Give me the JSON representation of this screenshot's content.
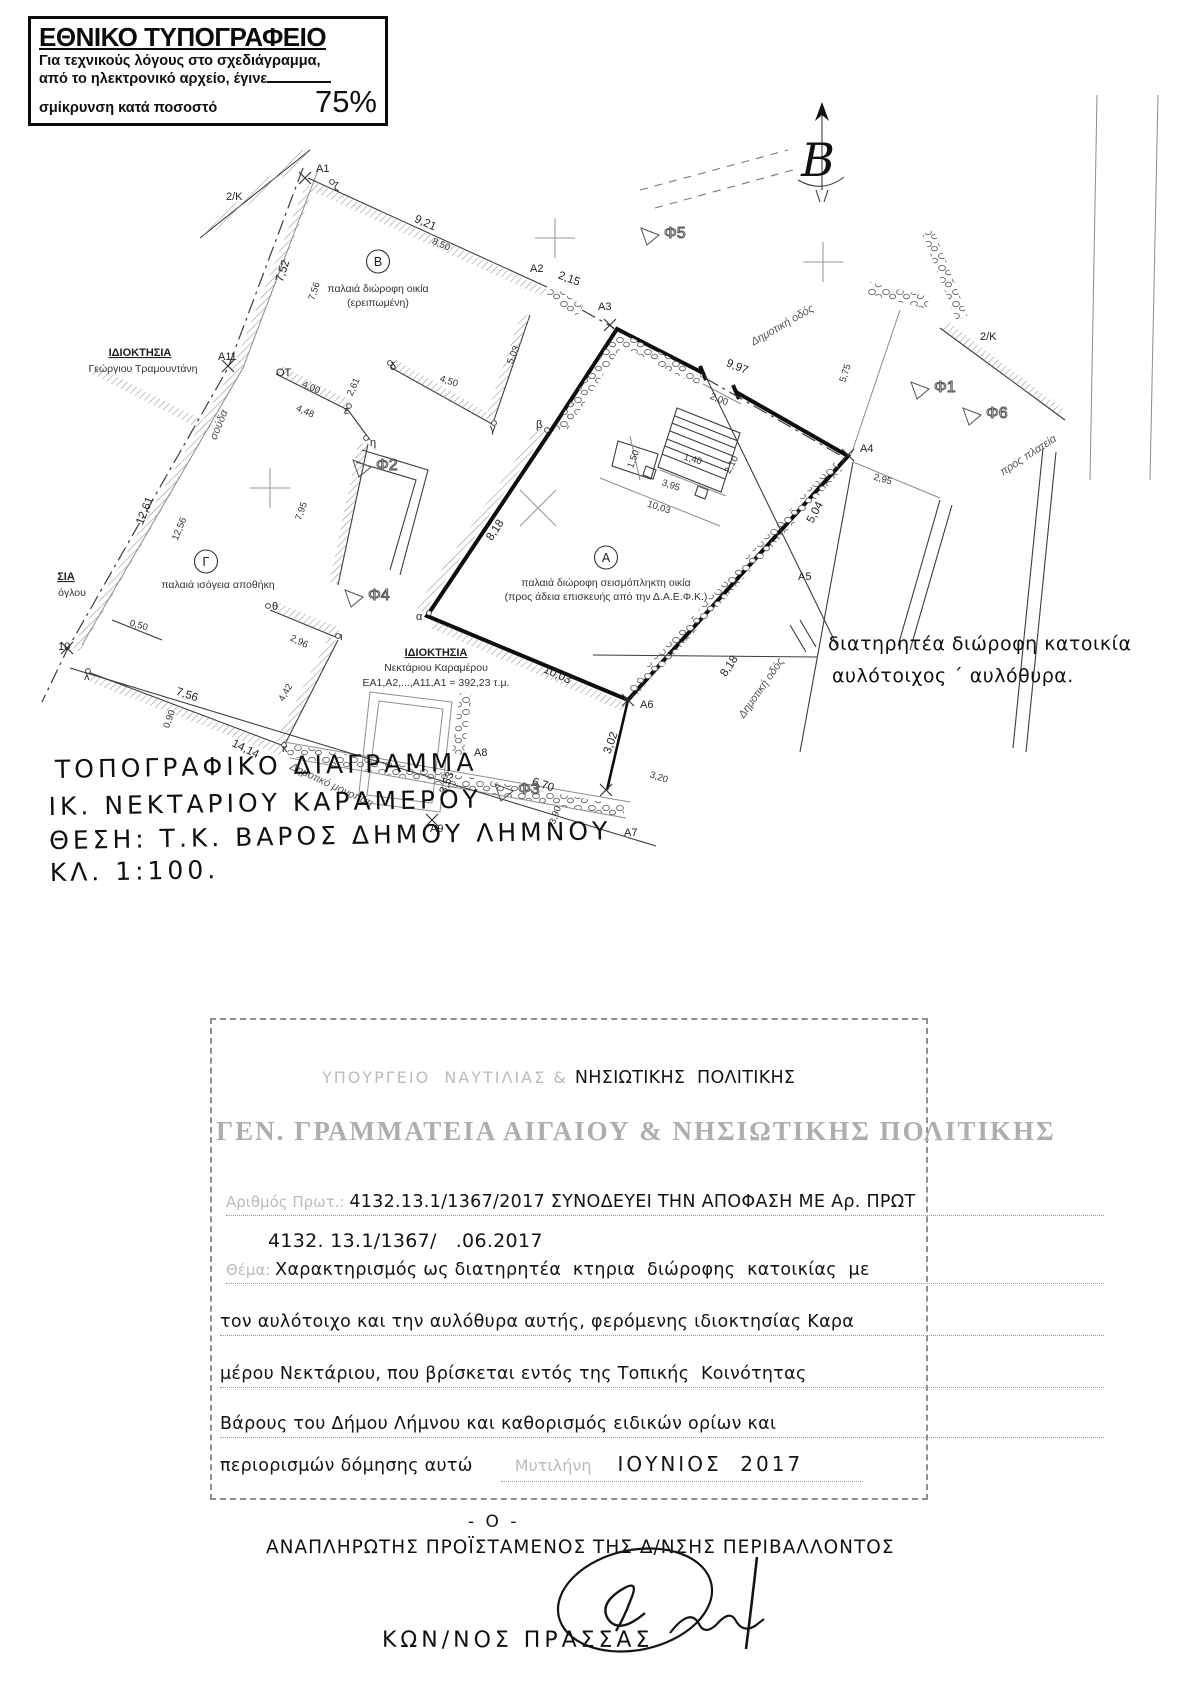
{
  "notice": {
    "title": "ΕΘΝΙΚΟ ΤΥΠΟΓΡΑΦΕΙΟ",
    "lines": [
      "Για τεχνικούς λόγους στο σχεδιάγραμμα,",
      "από το ηλεκτρονικό αρχείο, έγινε",
      "σμίκρυνση κατά ποσοστό"
    ],
    "percent": "75%"
  },
  "north": {
    "label": "Β"
  },
  "plan": {
    "labels": [
      {
        "t": "A1",
        "x": 316,
        "y": 172,
        "c": "m"
      },
      {
        "t": "ζ",
        "x": 334,
        "y": 190,
        "c": "m"
      },
      {
        "t": "2/Κ",
        "x": 226,
        "y": 200,
        "c": "m"
      },
      {
        "t": "9,21",
        "x": 424,
        "y": 226,
        "r": 24,
        "c": "d2"
      },
      {
        "t": "8,50",
        "x": 440,
        "y": 247,
        "r": 24,
        "c": "d"
      },
      {
        "t": "Β",
        "x": 378,
        "y": 266,
        "c": "circ"
      },
      {
        "t": "παλαιά διώροφη οικία",
        "x": 378,
        "y": 292,
        "c": "cap"
      },
      {
        "t": "(ερειπωμένη)",
        "x": 378,
        "y": 306,
        "c": "cap"
      },
      {
        "t": "A2",
        "x": 530,
        "y": 272,
        "c": "m"
      },
      {
        "t": "2,15",
        "x": 568,
        "y": 282,
        "r": 20,
        "c": "d2"
      },
      {
        "t": "A3",
        "x": 598,
        "y": 310,
        "c": "m"
      },
      {
        "t": "Δημοτική οδός",
        "x": 784,
        "y": 328,
        "r": -30,
        "c": "road"
      },
      {
        "t": "9,97",
        "x": 736,
        "y": 370,
        "r": 22,
        "c": "d2"
      },
      {
        "t": "5,75",
        "x": 848,
        "y": 374,
        "r": -72,
        "c": "d"
      },
      {
        "t": "2,00",
        "x": 718,
        "y": 402,
        "r": 22,
        "c": "d"
      },
      {
        "t": "A4",
        "x": 860,
        "y": 452,
        "c": "m"
      },
      {
        "t": "2,95",
        "x": 882,
        "y": 482,
        "r": 16,
        "c": "d"
      },
      {
        "t": "5,04",
        "x": 818,
        "y": 514,
        "r": -62,
        "c": "d2"
      },
      {
        "t": "προς πλατεία",
        "x": 1030,
        "y": 458,
        "r": -33,
        "c": "road"
      },
      {
        "t": "2/Κ",
        "x": 980,
        "y": 340,
        "c": "m"
      },
      {
        "t": "7,52",
        "x": 286,
        "y": 272,
        "r": -72,
        "c": "d2"
      },
      {
        "t": "7,56",
        "x": 317,
        "y": 292,
        "r": -72,
        "c": "d"
      },
      {
        "t": "ΙΔΙΟΚΤΗΣΙΑ",
        "x": 140,
        "y": 356,
        "c": "own"
      },
      {
        "t": "Γεώργιου Τραμουντάνη",
        "x": 143,
        "y": 372,
        "c": "cap"
      },
      {
        "t": "A11",
        "x": 218,
        "y": 360,
        "c": "m"
      },
      {
        "t": "ΟΤ",
        "x": 276,
        "y": 376,
        "c": "m"
      },
      {
        "t": "4,00",
        "x": 310,
        "y": 390,
        "r": 24,
        "c": "d"
      },
      {
        "t": "4,48",
        "x": 304,
        "y": 414,
        "r": 24,
        "c": "d"
      },
      {
        "t": "2,61",
        "x": 356,
        "y": 388,
        "r": -66,
        "c": "d"
      },
      {
        "t": "δ",
        "x": 390,
        "y": 370,
        "c": "m"
      },
      {
        "t": "ε",
        "x": 344,
        "y": 414,
        "c": "m"
      },
      {
        "t": "η",
        "x": 370,
        "y": 446,
        "c": "m"
      },
      {
        "t": "5,03",
        "x": 516,
        "y": 356,
        "r": -68,
        "c": "d"
      },
      {
        "t": "4,50",
        "x": 448,
        "y": 384,
        "r": 18,
        "c": "d"
      },
      {
        "t": "γ",
        "x": 490,
        "y": 432,
        "c": "m"
      },
      {
        "t": "β",
        "x": 536,
        "y": 428,
        "c": "m"
      },
      {
        "t": "σούδα",
        "x": 222,
        "y": 426,
        "r": -68,
        "c": "road"
      },
      {
        "t": "12,61",
        "x": 148,
        "y": 512,
        "r": -68,
        "c": "d2"
      },
      {
        "t": "12,56",
        "x": 182,
        "y": 530,
        "r": -68,
        "c": "d"
      },
      {
        "t": "7,95",
        "x": 304,
        "y": 512,
        "r": -70,
        "c": "d"
      },
      {
        "t": "Φ2",
        "x": 376,
        "y": 470,
        "c": "phi"
      },
      {
        "t": "ΣΙΑ",
        "x": 66,
        "y": 580,
        "c": "own"
      },
      {
        "t": "όγλου",
        "x": 72,
        "y": 596,
        "c": "cap"
      },
      {
        "t": "Γ",
        "x": 206,
        "y": 566,
        "c": "circ"
      },
      {
        "t": "παλαιά ισόγεια αποθήκη",
        "x": 218,
        "y": 588,
        "c": "cap"
      },
      {
        "t": "0,50",
        "x": 138,
        "y": 628,
        "r": 16,
        "c": "d"
      },
      {
        "t": "10",
        "x": 58,
        "y": 650,
        "c": "m"
      },
      {
        "t": "λ",
        "x": 84,
        "y": 680,
        "c": "m"
      },
      {
        "t": "θ",
        "x": 272,
        "y": 610,
        "c": "m"
      },
      {
        "t": "2,96",
        "x": 298,
        "y": 644,
        "r": 26,
        "c": "d"
      },
      {
        "t": "ι",
        "x": 340,
        "y": 640,
        "c": "m"
      },
      {
        "t": "4,42",
        "x": 288,
        "y": 694,
        "r": -60,
        "c": "d"
      },
      {
        "t": "7,56",
        "x": 186,
        "y": 698,
        "r": 18,
        "c": "d2"
      },
      {
        "t": "0,90",
        "x": 172,
        "y": 720,
        "r": -70,
        "c": "d"
      },
      {
        "t": "14,14",
        "x": 244,
        "y": 752,
        "r": 26,
        "c": "d2"
      },
      {
        "t": "κ",
        "x": 282,
        "y": 752,
        "c": "m"
      },
      {
        "t": "Δημοτικό μονοπάτι",
        "x": 330,
        "y": 788,
        "r": 25,
        "c": "road"
      },
      {
        "t": "Α",
        "x": 606,
        "y": 562,
        "c": "circ"
      },
      {
        "t": "παλαιά διώροφη σεισμόπληκτη οικία",
        "x": 606,
        "y": 586,
        "c": "cap"
      },
      {
        "t": "(προς άδεια επισκευής από την Δ.Α.Ε.Φ.Κ.)",
        "x": 606,
        "y": 600,
        "c": "cap"
      },
      {
        "t": "α",
        "x": 416,
        "y": 620,
        "c": "m"
      },
      {
        "t": "8,18",
        "x": 498,
        "y": 532,
        "r": -56,
        "c": "d2"
      },
      {
        "t": "8,18",
        "x": 732,
        "y": 668,
        "r": -56,
        "c": "d2"
      },
      {
        "t": "10,03",
        "x": 556,
        "y": 678,
        "r": 24,
        "c": "d2"
      },
      {
        "t": "10,03",
        "x": 658,
        "y": 510,
        "r": 18,
        "c": "d"
      },
      {
        "t": "3,95",
        "x": 670,
        "y": 488,
        "r": 18,
        "c": "d"
      },
      {
        "t": "1,50",
        "x": 636,
        "y": 460,
        "r": -70,
        "c": "d"
      },
      {
        "t": "1,40",
        "x": 692,
        "y": 462,
        "r": 16,
        "c": "d"
      },
      {
        "t": "2,10",
        "x": 734,
        "y": 466,
        "r": -62,
        "c": "d"
      },
      {
        "t": "A5",
        "x": 798,
        "y": 580,
        "c": "m"
      },
      {
        "t": "Δημοτική οδός",
        "x": 764,
        "y": 690,
        "r": -55,
        "c": "road"
      },
      {
        "t": "ΙΔΙΟΚΤΗΣΙΑ",
        "x": 436,
        "y": 656,
        "c": "own"
      },
      {
        "t": "Νεκτάριου Καραμέρου",
        "x": 436,
        "y": 671,
        "c": "cap"
      },
      {
        "t": "ΕΑ1,Α2,...,Α11,Α1 = 392,23 τ.μ.",
        "x": 436,
        "y": 686,
        "c": "cap"
      },
      {
        "t": "A6",
        "x": 640,
        "y": 708,
        "c": "m"
      },
      {
        "t": "A8",
        "x": 474,
        "y": 756,
        "c": "m"
      },
      {
        "t": "3,53",
        "x": 450,
        "y": 784,
        "r": -70,
        "c": "d2"
      },
      {
        "t": "6,70",
        "x": 542,
        "y": 788,
        "r": 18,
        "c": "d2"
      },
      {
        "t": "3,02",
        "x": 614,
        "y": 744,
        "r": -70,
        "c": "d2"
      },
      {
        "t": "A9",
        "x": 430,
        "y": 832,
        "c": "m"
      },
      {
        "t": "A7",
        "x": 624,
        "y": 836,
        "c": "m"
      },
      {
        "t": "3,20",
        "x": 658,
        "y": 780,
        "r": 18,
        "c": "d"
      },
      {
        "t": "3,90",
        "x": 558,
        "y": 816,
        "r": -70,
        "c": "d"
      },
      {
        "t": "Φ1",
        "x": 934,
        "y": 392,
        "c": "phi"
      },
      {
        "t": "Φ6",
        "x": 986,
        "y": 418,
        "c": "phi"
      },
      {
        "t": "Φ5",
        "x": 664,
        "y": 238,
        "c": "phi"
      },
      {
        "t": "Φ4",
        "x": 368,
        "y": 600,
        "c": "phi"
      },
      {
        "t": "Φ3",
        "x": 518,
        "y": 794,
        "c": "phi"
      }
    ]
  },
  "annotation": {
    "line1": "διατηρητέα διώροφη κατοικία",
    "line2": "αυλότοιχος ΄ αυλόθυρα."
  },
  "title_block": {
    "line1": "ΤΟΠΟΓΡΑΦΙΚΟ ΔΙΑΓΡΑΜΜΑ",
    "line2": "ΙΚ. ΝΕΚΤΑΡΙΟΥ ΚΑΡΑΜΕΡΟΥ",
    "line3": "ΘΕΣΗ: Τ.Κ. ΒΑΡΟΣ ΔΗΜΟΥ ΛΗΜΝΟΥ",
    "line4": "ΚΛ. 1:100."
  },
  "stamp": {
    "ministry_faded": "ΥΠΟΥΡΓΕΙΟ  ΝΑΥΤΙΛΙΑΣ & ",
    "ministry_hand": "ΝΗΣΙΩΤΙΚΗΣ  ΠΟΛΙΤΙΚΗΣ",
    "secretariat": "ΓΕΝ. ΓΡΑΜΜΑΤΕΙΑ ΑΙΓΑΙΟΥ & ΝΗΣΙΩΤΙΚΗΣ ΠΟΛΙΤΙΚΗΣ",
    "protocol_label": "Αριθμός Πρωτ.: ",
    "protocol_hand": "4132.13.1/1367/2017 ΣΥΝΟΔΕΥΕΙ ΤΗΝ ΑΠΟΦΑΣΗ ΜΕ Αρ. ΠΡΩΤ",
    "protocol_line2": "4132. 13.1/1367/   .06.2017",
    "subject_label": "Θέμα: ",
    "subject_lines": [
      "Χαρακτηρισμός ως διατηρητέα  κτηρια  διώροφης  κατοικίας  με",
      "τον αυλότοιχο και την αυλόθυρα αυτής, φερόμενης ιδιοκτησίας Καρα",
      "μέρου Νεκτάριου, που βρίσκεται εντός της Τοπικής  Κοινότητας",
      "Βάρους του Δήμου Λήμνου και καθορισμός ειδικών ορίων και",
      "περιορισμών δόμησης αυτώ"
    ],
    "place_label": "Μυτιλήνη",
    "date_hand": "ΙΟΥΝΙΟΣ  2017"
  },
  "signature": {
    "dash_o": "- Ο -",
    "title": "ΑΝΑΠΛΗΡΩΤΗΣ  ΠΡΟΪΣΤΑΜΕΝΟΣ  ΤΗΣ  Δ/ΝΣΗΣ  ΠΕΡΙΒΑΛΛΟΝΤΟΣ",
    "name": "ΚΩΝ/ΝΟΣ   ΠΡΑΣΣΑΣ"
  }
}
